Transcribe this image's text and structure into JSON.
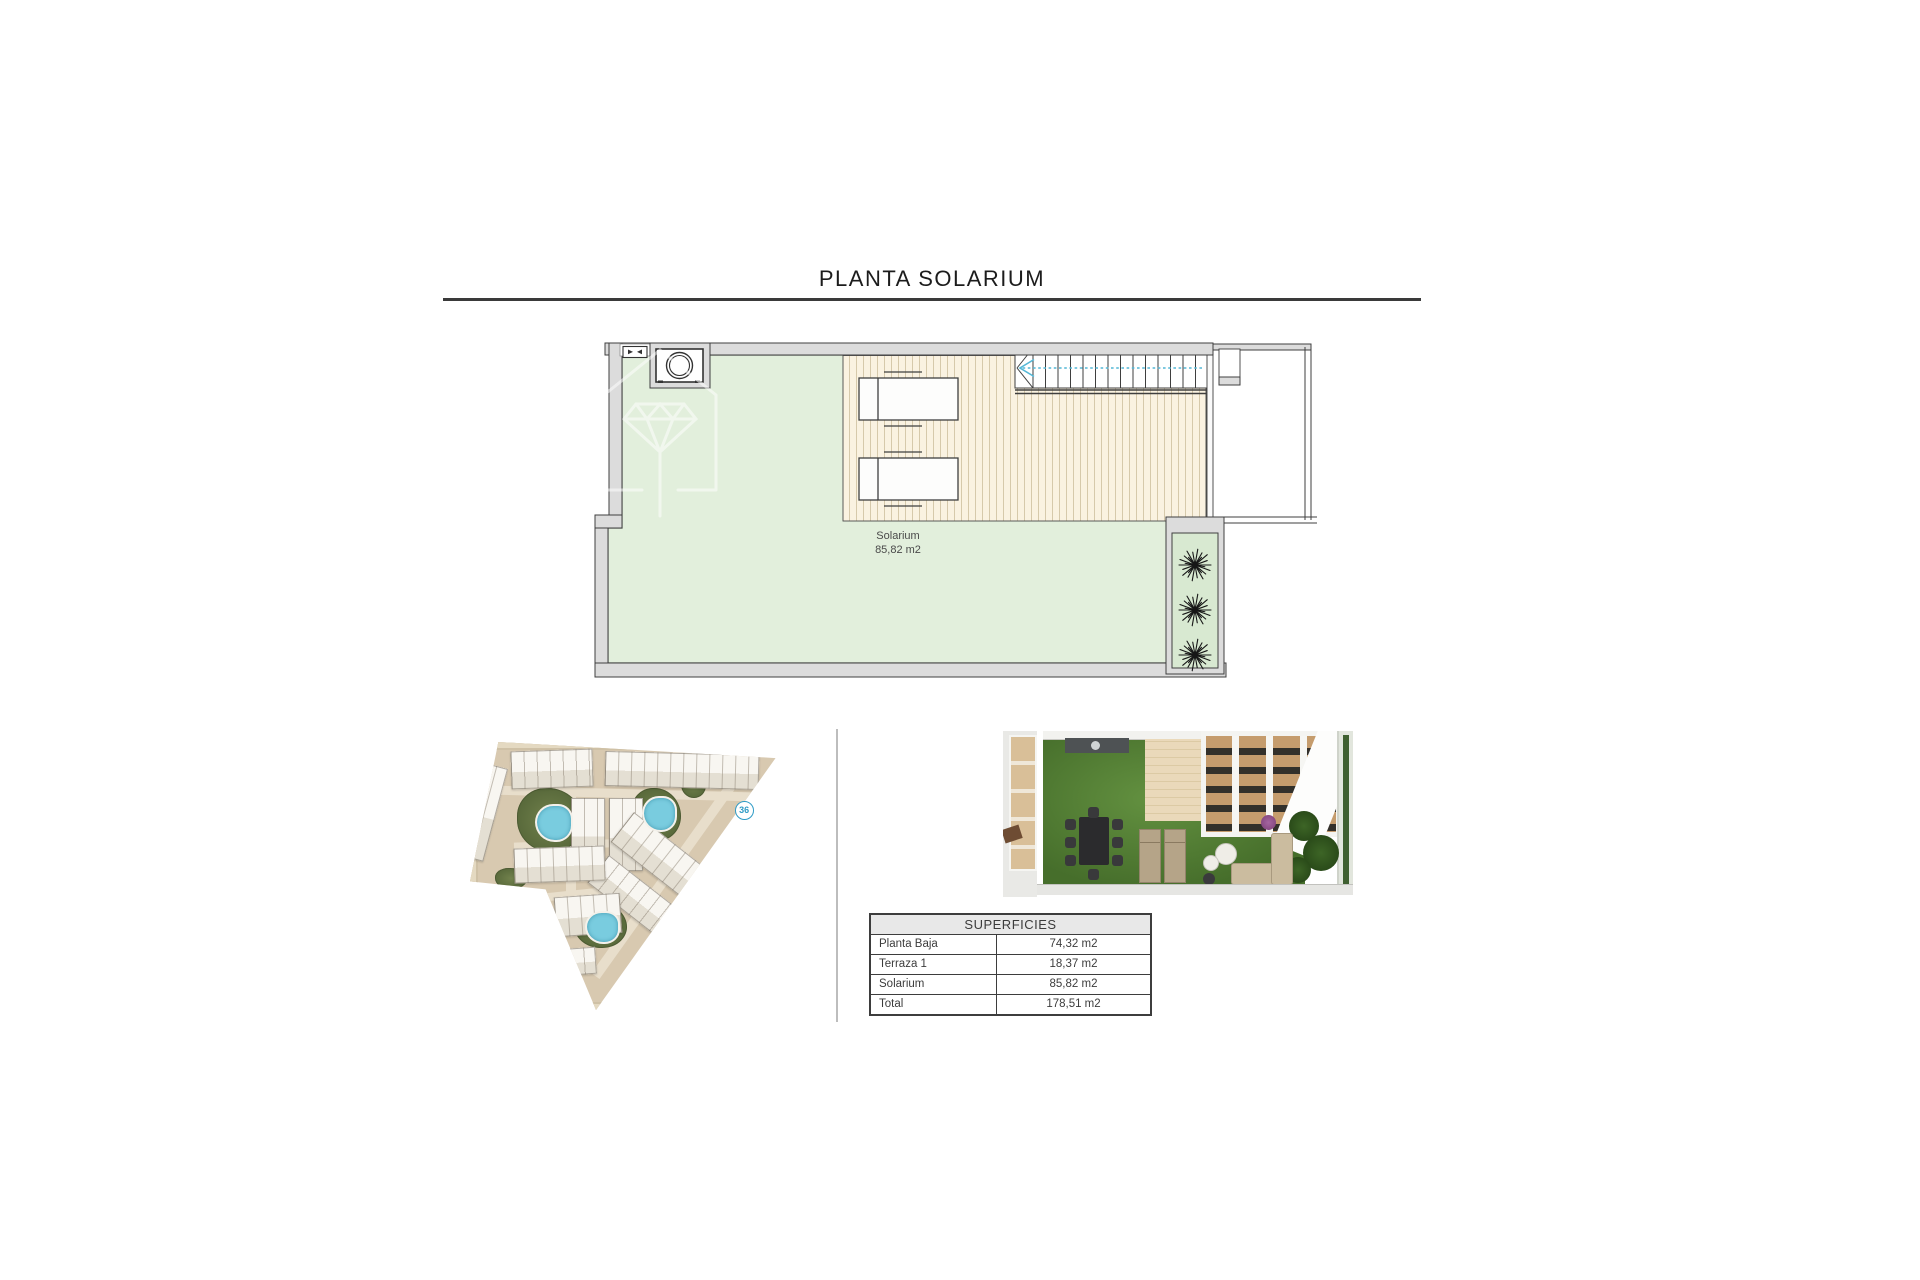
{
  "title": "PLANTA SOLARIUM",
  "floor_plan": {
    "room": {
      "name": "Solarium",
      "area": "85,82 m2"
    }
  },
  "site_plan": {
    "unit_badge": "36"
  },
  "table": {
    "header": "SUPERFICIES",
    "rows": [
      {
        "label": "Planta Baja",
        "value": "74,32 m2"
      },
      {
        "label": "Terraza 1",
        "value": "18,37 m2"
      },
      {
        "label": "Solarium",
        "value": "85,82 m2"
      },
      {
        "label": "Total",
        "value": "178,51 m2"
      }
    ]
  },
  "colors": {
    "plan_green": "#e2efdc",
    "deck_cream": "#faf2e1",
    "wall_gray": "#dcdcdc",
    "line_dark": "#3f3f3f",
    "arrow_blue": "#54b7d6",
    "pool_blue": "#79ccdf",
    "site_tan": "#d8c9b0",
    "grass_green": "#466e2b",
    "badge_blue": "#2e9bc6"
  }
}
